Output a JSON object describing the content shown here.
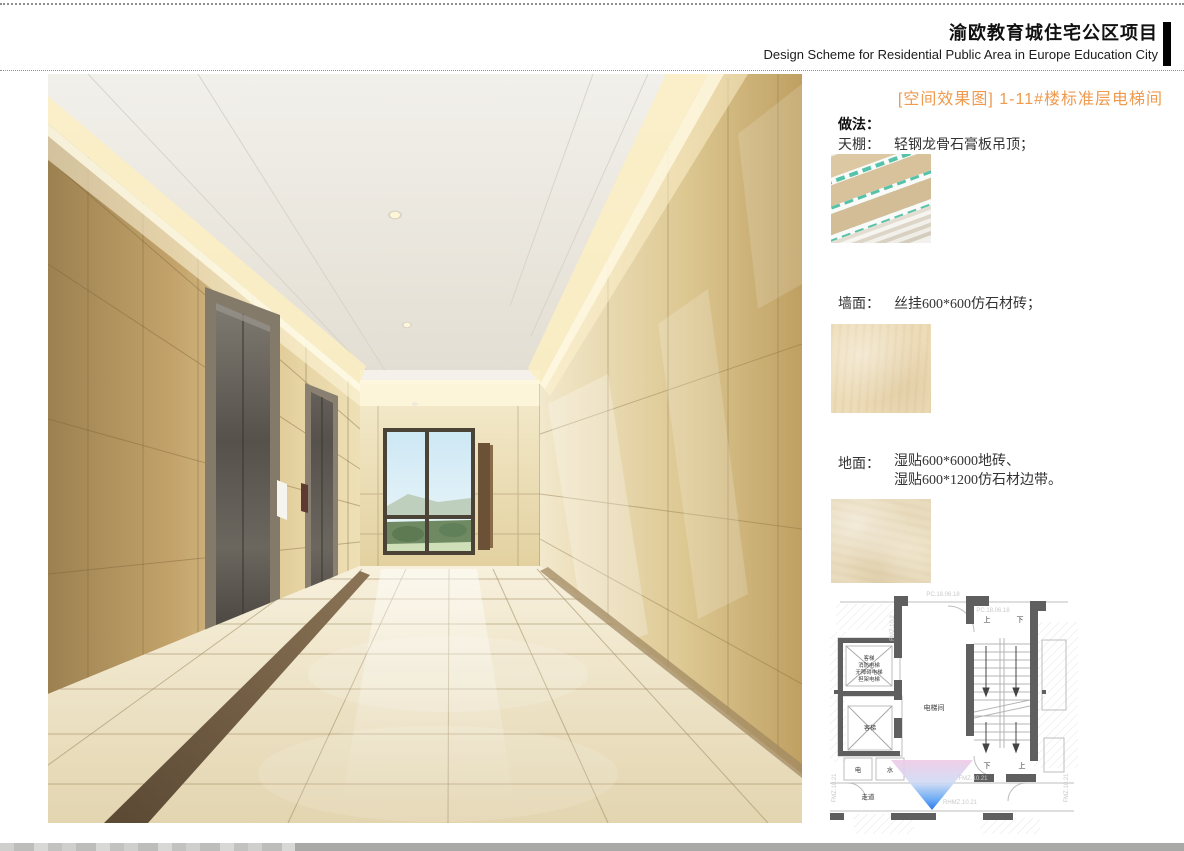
{
  "header": {
    "title_cn": "渝欧教育城住宅公区项目",
    "title_en": "Design Scheme for Residential Public Area in Europe Education City"
  },
  "caption": {
    "text": "[空间效果图] 1-11#楼标准层电梯间",
    "color": "#ef9a4e"
  },
  "notes": {
    "method_title": "做法：",
    "items": [
      {
        "label": "天棚：",
        "text": "轻钢龙骨石膏板吊顶；",
        "swatch": "gypsum-board-image"
      },
      {
        "label": "墙面：",
        "text": "丝挂600*600仿石材砖；",
        "swatch": "stone-tile-image"
      },
      {
        "label": "地面：",
        "text": "湿贴600*6000地砖、",
        "text2": "湿贴600*1200仿石材边带。",
        "swatch": "floor-tile-image"
      }
    ]
  },
  "floor_plan": {
    "room_labels": {
      "elevator_hall": "电梯间",
      "shaft_line1": "客梯",
      "shaft_line2": "消防电梯",
      "shaft_line3": "无障碍电梯",
      "shaft_line4": "担架电梯",
      "shaft2": "客梯",
      "electrical": "电",
      "water": "水",
      "corridor": "走道",
      "up_top": "上",
      "down_top": "下",
      "down_bottom": "下",
      "up_bottom": "上"
    },
    "codes": {
      "top1": "PC.18.06.18",
      "top2": "PC.18.06.18",
      "left_v": "FMZ.10.2",
      "mid": "FMZ.10.21",
      "bottom": "RHMZ.10.21",
      "edge_left": "FMZ.10.21",
      "edge_right": "FMZ.10.21"
    }
  },
  "colors": {
    "accent_orange": "#ef9a4e",
    "plan_wall": "#5f5f5f",
    "view_cone_top": "#eec9e6",
    "view_cone_bottom": "#1668e8"
  }
}
